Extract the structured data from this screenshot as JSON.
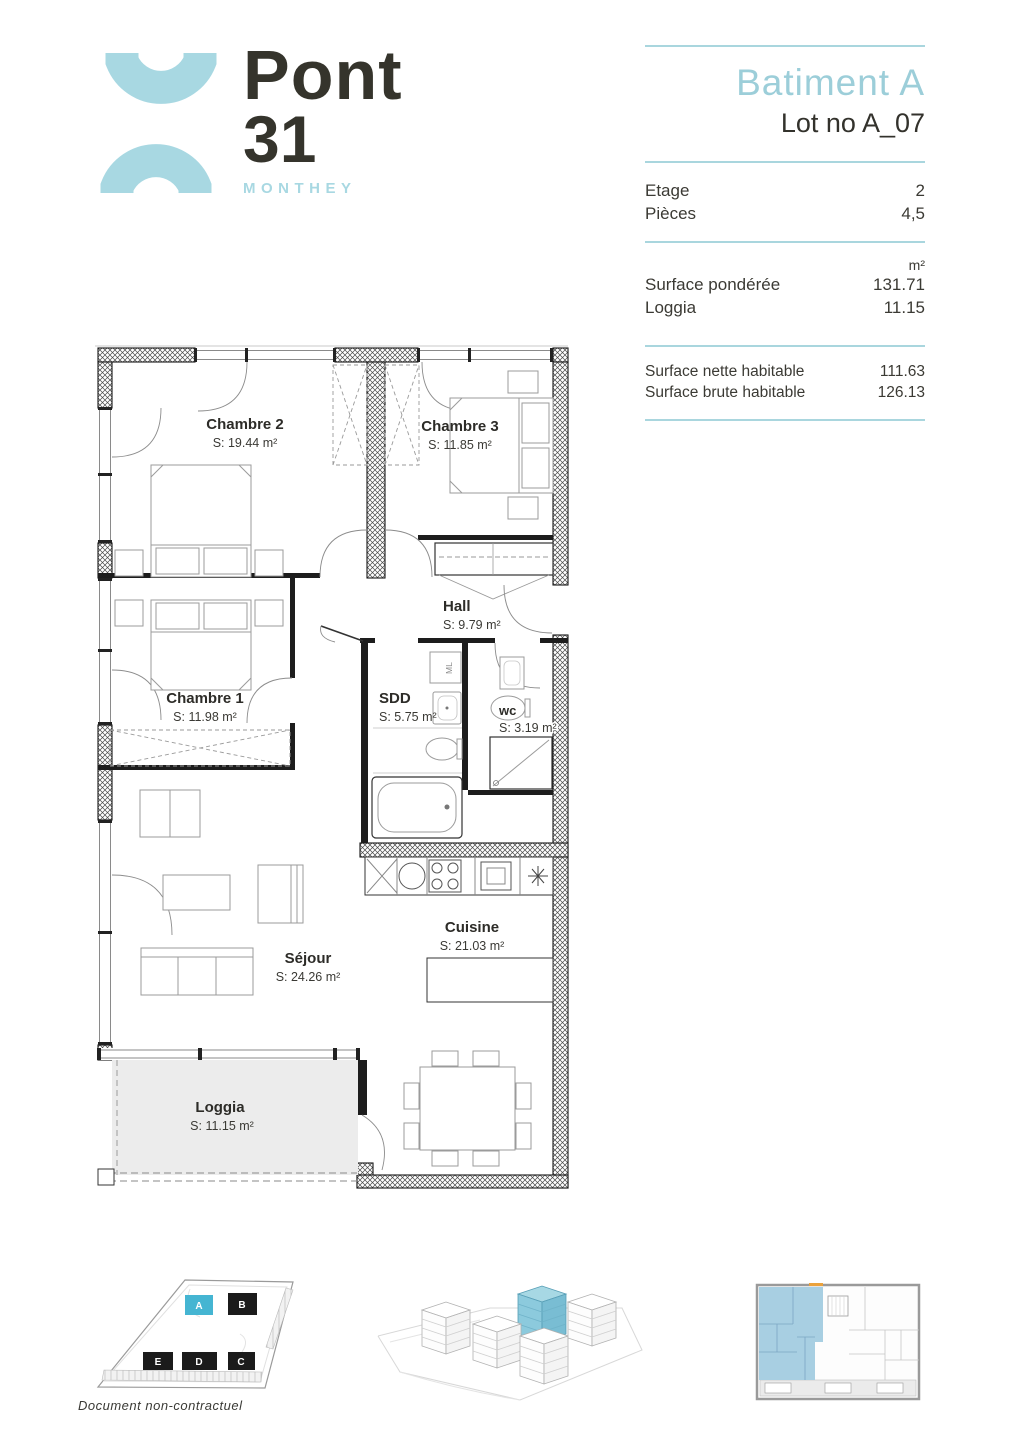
{
  "logo": {
    "name": "Pont",
    "number": "31",
    "city": "MONTHEY"
  },
  "panel": {
    "building": "Batiment A",
    "lot": "Lot no A_07",
    "rows1": [
      {
        "label": "Etage",
        "value": "2"
      },
      {
        "label": "Pièces",
        "value": "4,5"
      }
    ],
    "unit": "m²",
    "rows2": [
      {
        "label": "Surface pondérée",
        "value": "131.71"
      },
      {
        "label": "Loggia",
        "value": "11.15"
      }
    ],
    "rows3": [
      {
        "label": "Surface nette habitable",
        "value": "111.63"
      },
      {
        "label": "Surface brute habitable",
        "value": "126.13"
      }
    ]
  },
  "floorplan": {
    "rooms": [
      {
        "name": "Chambre 2",
        "area": "S: 19.44 m²"
      },
      {
        "name": "Chambre 3",
        "area": "S: 11.85 m²"
      },
      {
        "name": "Hall",
        "area": "S: 9.79 m²"
      },
      {
        "name": "Chambre 1",
        "area": "S: 11.98 m²"
      },
      {
        "name": "SDD",
        "area": "S: 5.75 m²"
      },
      {
        "name": "wc",
        "area": "S: 3.19 m²"
      },
      {
        "name": "Séjour",
        "area": "S: 24.26 m²"
      },
      {
        "name": "Cuisine",
        "area": "S: 21.03 m²"
      },
      {
        "name": "Loggia",
        "area": "S: 11.15 m²"
      }
    ],
    "ml_label": "ML"
  },
  "siteplan": {
    "blocks": [
      {
        "label": "A",
        "highlighted": true
      },
      {
        "label": "B",
        "highlighted": false
      },
      {
        "label": "E",
        "highlighted": false
      },
      {
        "label": "D",
        "highlighted": false
      },
      {
        "label": "C",
        "highlighted": false
      }
    ],
    "highlight_color": "#45b5d2",
    "block_color": "#1b1b1b"
  },
  "colors": {
    "accent_blue": "#9fd0da",
    "logo_blue": "#a8d8e2",
    "dark": "#35342f"
  },
  "footer": {
    "disclaimer": "Document non-contractuel"
  }
}
